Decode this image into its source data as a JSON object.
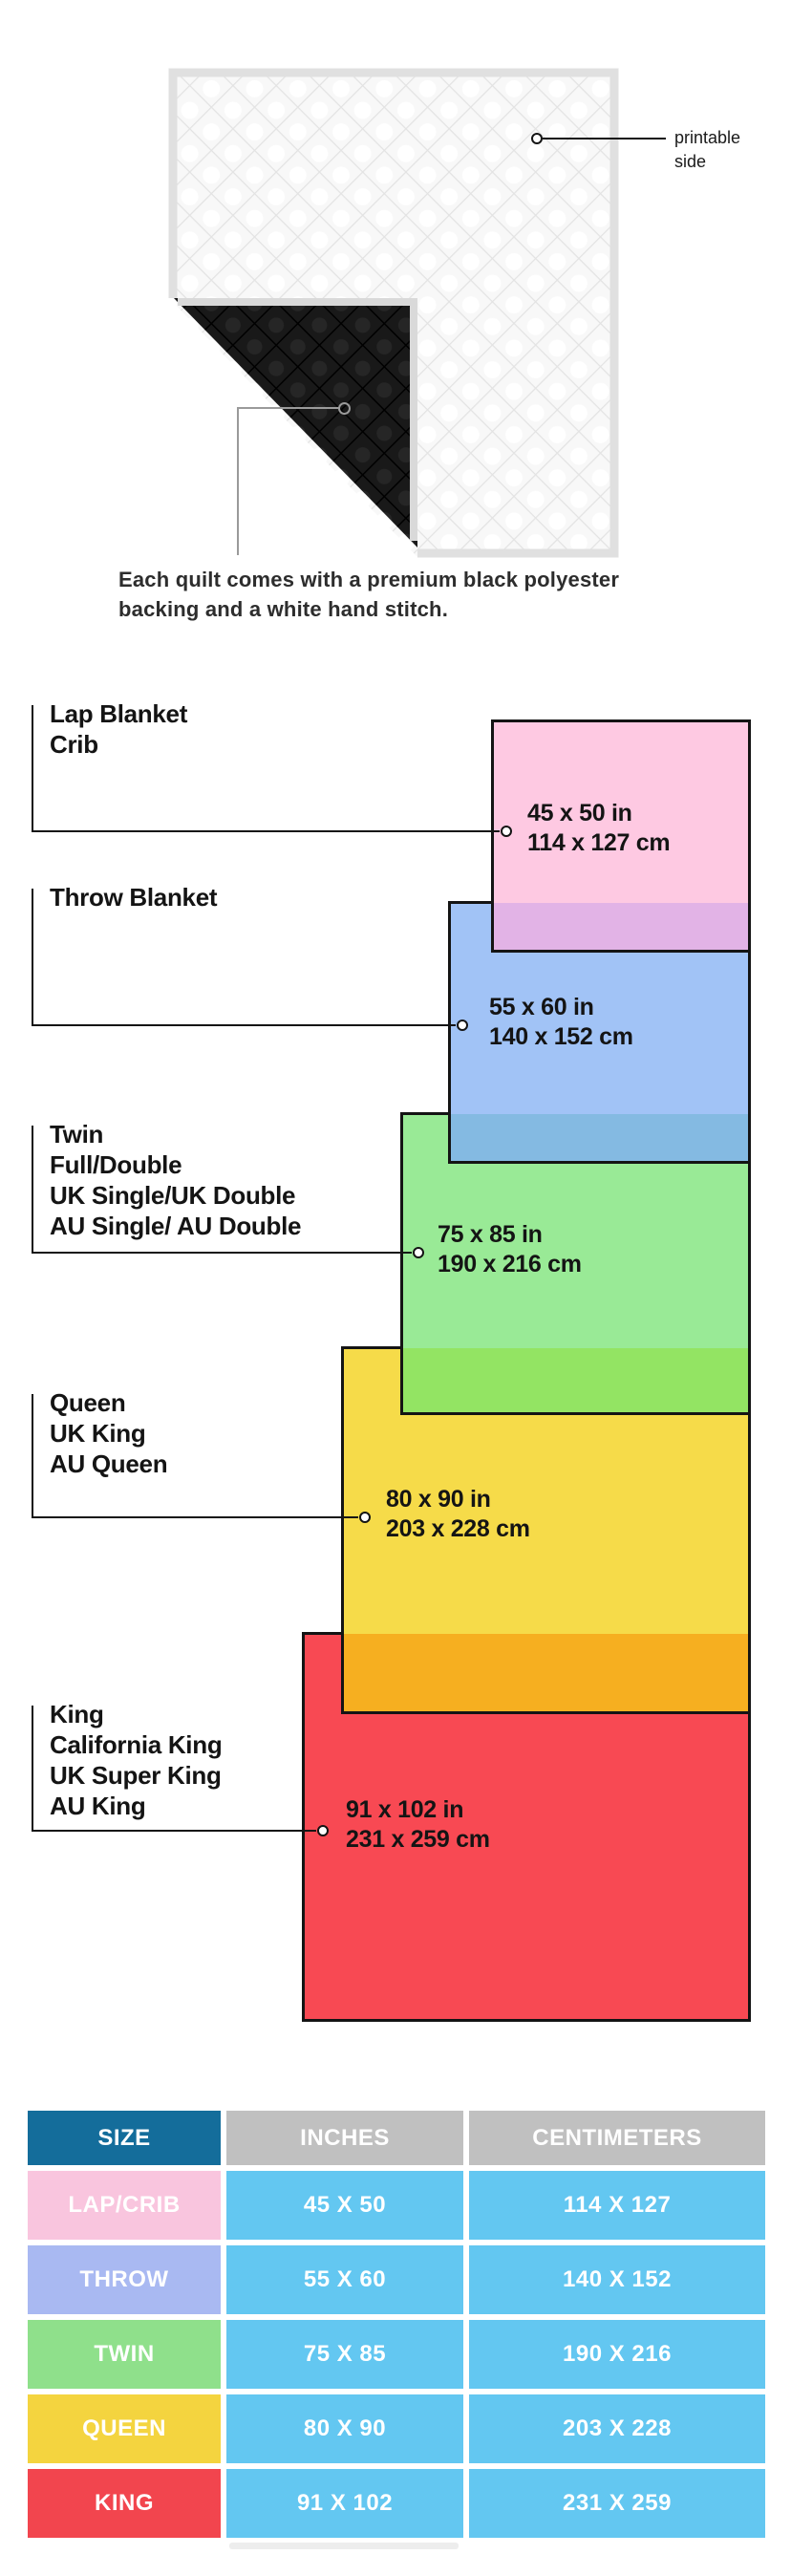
{
  "quilt_section": {
    "printable_label": {
      "line1": "printable",
      "line2": "side"
    },
    "caption": {
      "line1": "Each quilt comes with a premium black polyester",
      "line2": "backing and a white hand stitch."
    }
  },
  "diagram": {
    "line_color": "#141414",
    "sizes": [
      {
        "names": [
          "Lap Blanket",
          "Crib"
        ],
        "inches": "45 x 50 in",
        "cm": "114 x 127 cm",
        "color": "#FEC9E2"
      },
      {
        "names": [
          "Throw Blanket"
        ],
        "inches": "55 x 60 in",
        "cm": "140 x 152 cm",
        "color": "#A1C3F6"
      },
      {
        "names": [
          "Twin",
          "Full/Double",
          "UK Single/UK Double",
          "AU Single/ AU Double"
        ],
        "inches": "75 x 85 in",
        "cm": "190 x 216 cm",
        "color": "#99EA96"
      },
      {
        "names": [
          "Queen",
          "UK King",
          "AU Queen"
        ],
        "inches": "80 x 90 in",
        "cm": "203 x 228 cm",
        "color": "#F6DB49"
      },
      {
        "names": [
          "King",
          "California King",
          "UK Super King",
          "AU King"
        ],
        "inches": "91 x 102 in",
        "cm": "231 x 259 cm",
        "color": "#F84953"
      }
    ],
    "overlaps": [
      "#E2B3E6",
      "#84BAE2",
      "#93E463",
      "#F6AF20"
    ]
  },
  "table": {
    "headers": [
      "SIZE",
      "INCHES",
      "CENTIMETERS"
    ],
    "header_colors": {
      "size": "#146D9B",
      "other": "#C0C0C0"
    },
    "value_cell_color": "#63C7F1",
    "rows": [
      {
        "size": "LAP/CRIB",
        "inches": "45 X 50",
        "cm": "114 X 127",
        "color": "#F9C5DE"
      },
      {
        "size": "THROW",
        "inches": "55 X 60",
        "cm": "140 X 152",
        "color": "#A9B9F2"
      },
      {
        "size": "TWIN",
        "inches": "75 X 85",
        "cm": "190 X 216",
        "color": "#8FE08B"
      },
      {
        "size": "QUEEN",
        "inches": "80 X 90",
        "cm": "203 X 228",
        "color": "#F4D43F"
      },
      {
        "size": "KING",
        "inches": "91 X 102",
        "cm": "231 X 259",
        "color": "#F2454E"
      }
    ]
  }
}
